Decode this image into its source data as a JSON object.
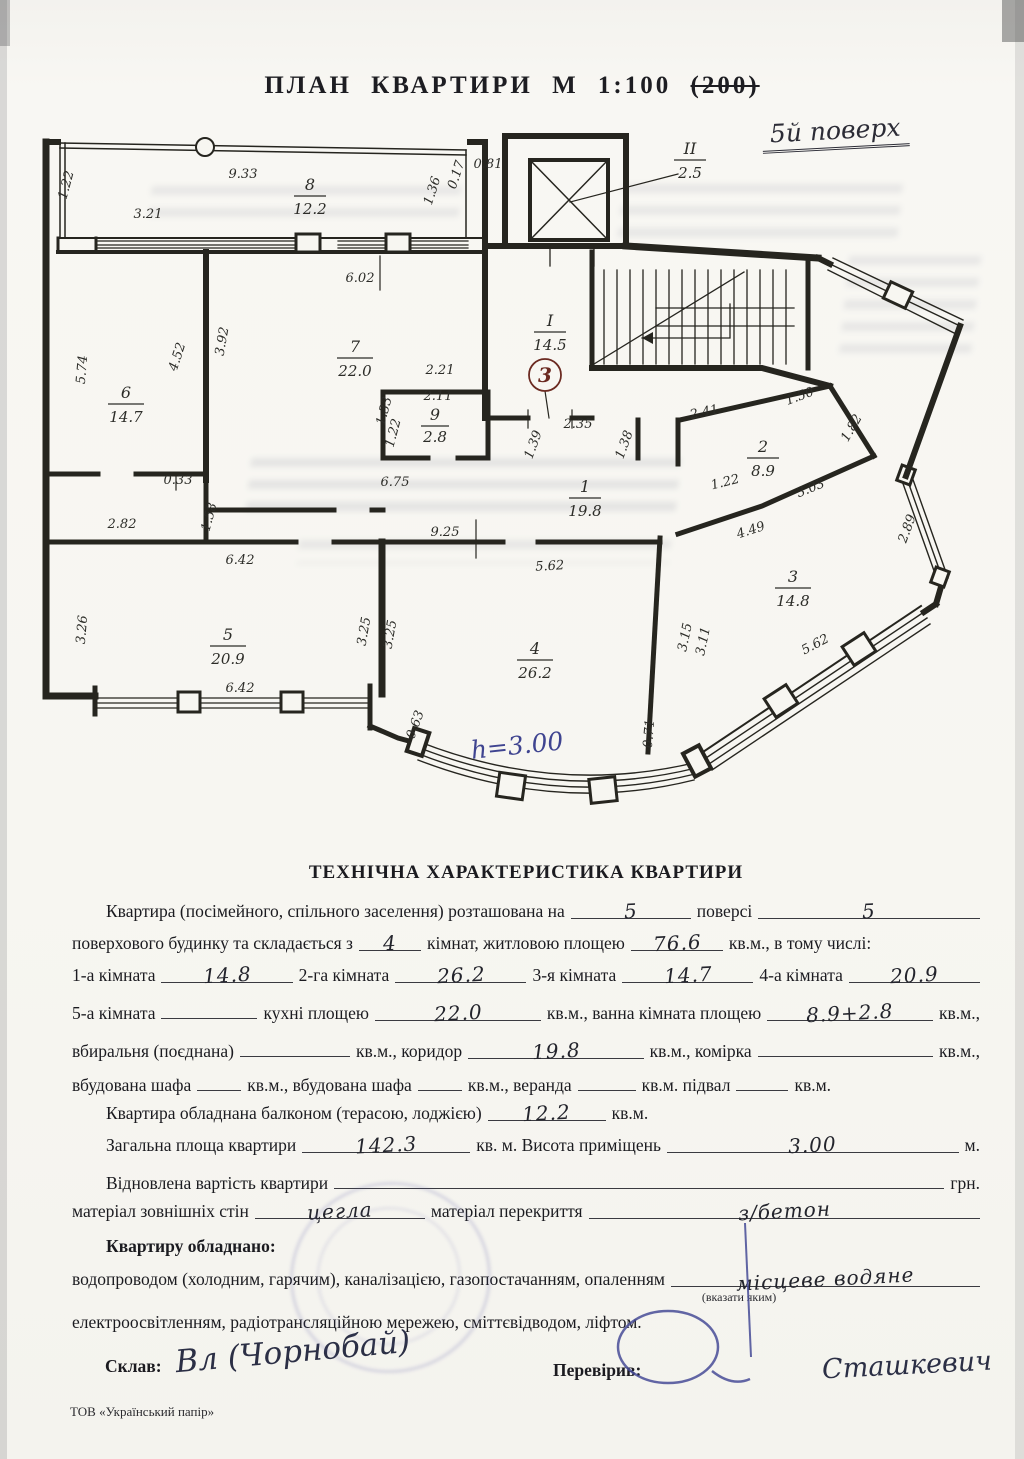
{
  "page": {
    "title": "ПЛАН КВАРТИРИ М 1:100",
    "title_struck": "(200)",
    "floor_note": "5й поверх",
    "footer": "ТОВ «Український папір»"
  },
  "plan": {
    "rooms": [
      {
        "num": "8",
        "area": "12.2"
      },
      {
        "num": "7",
        "area": "22.0"
      },
      {
        "num": "6",
        "area": "14.7"
      },
      {
        "num": "9",
        "area": "2.8"
      },
      {
        "num": "5",
        "area": "20.9"
      },
      {
        "num": "4",
        "area": "26.2"
      },
      {
        "num": "3",
        "area": "14.8"
      },
      {
        "num": "2",
        "area": "8.9"
      },
      {
        "num": "1",
        "area": "19.8"
      }
    ],
    "stair": {
      "num": "I",
      "area": "14.5"
    },
    "elevator": {
      "num": "II",
      "area": "2.5"
    },
    "entry_mark": "3",
    "height_note": "h=3.00",
    "dims": [
      "1.22",
      "9.33",
      "3.21",
      "1.36",
      "0.17",
      "0.81",
      "6.02",
      "3.92",
      "4.52",
      "5.74",
      "2.21",
      "2.11",
      "1.33",
      "1.22",
      "6.75",
      "0.33",
      "2.82",
      "1.58",
      "2.35",
      "1.39",
      "1.38",
      "1.22",
      "2.41",
      "1.50",
      "1.82",
      "3.03",
      "4.49",
      "2.89",
      "9.25",
      "5.62",
      "6.42",
      "3.26",
      "3.25",
      "3.25",
      "6.42",
      "3.15",
      "3.11",
      "5.62",
      "0.63",
      "0.71"
    ]
  },
  "form": {
    "heading": "ТЕХНІЧНА ХАРАКТЕРИСТИКА КВАРТИРИ",
    "line1": {
      "t1": "Квартира (посімейного, спільного заселення) розташована на",
      "v1": "5",
      "t2": "поверсі",
      "v2": "5"
    },
    "line2": {
      "t1": "поверхового будинку та складається з",
      "v1": "4",
      "t2": "кімнат, житловою площею",
      "v2": "76.6",
      "t3": "кв.м., в тому числі:"
    },
    "line3": {
      "t1": "1-а кімната",
      "v1": "14.8",
      "t2": "2-га кімната",
      "v2": "26.2",
      "t3": "3-я кімната",
      "v3": "14.7",
      "t4": "4-а кімната",
      "v4": "20.9"
    },
    "line4": {
      "t1": "5-а кімната",
      "t2": "кухні площею",
      "v2": "22.0",
      "t3": "кв.м., ванна кімната площею",
      "v3": "8.9+2.8",
      "t4": "кв.м.,"
    },
    "line5": {
      "t1": "вбиральня (поєднана)",
      "t2": "кв.м., коридор",
      "v2": "19.8",
      "t3": "кв.м., комірка",
      "t4": "кв.м.,"
    },
    "line6": {
      "t1": "вбудована шафа",
      "t2": "кв.м., вбудована шафа",
      "t3": "кв.м., веранда",
      "t4": "кв.м. підвал",
      "t5": "кв.м."
    },
    "line7": {
      "t1": "Квартира обладнана балконом (терасою, лоджією)",
      "v1": "12.2",
      "t2": "кв.м."
    },
    "line8": {
      "t1": "Загальна площа квартири",
      "v1": "142.3",
      "t2": "кв. м. Висота приміщень",
      "v2": "3.00",
      "t3": "м."
    },
    "line9": {
      "t1": "Відновлена вартість квартири",
      "t2": "грн."
    },
    "line10": {
      "t1": "матеріал зовнішніх стін",
      "v1": "цегла",
      "t2": "матеріал перекриття",
      "v2": "з/бетон"
    },
    "line11": "Квартиру обладнано:",
    "line12": {
      "t1": "водопроводом (холодним, гарячим), каналізацією, газопостачанням, опаленням",
      "v1": "місцеве водяне",
      "note": "(вказати яким)"
    },
    "line13": "електроосвітленням, радіотрансляційною мережею, сміттєвідводом, ліфтом.",
    "made_label": "Склав:",
    "made_sig": "Вл (Чорнобай)",
    "checked_label": "Перевірив:",
    "checked_sig": "Сташкевич"
  }
}
